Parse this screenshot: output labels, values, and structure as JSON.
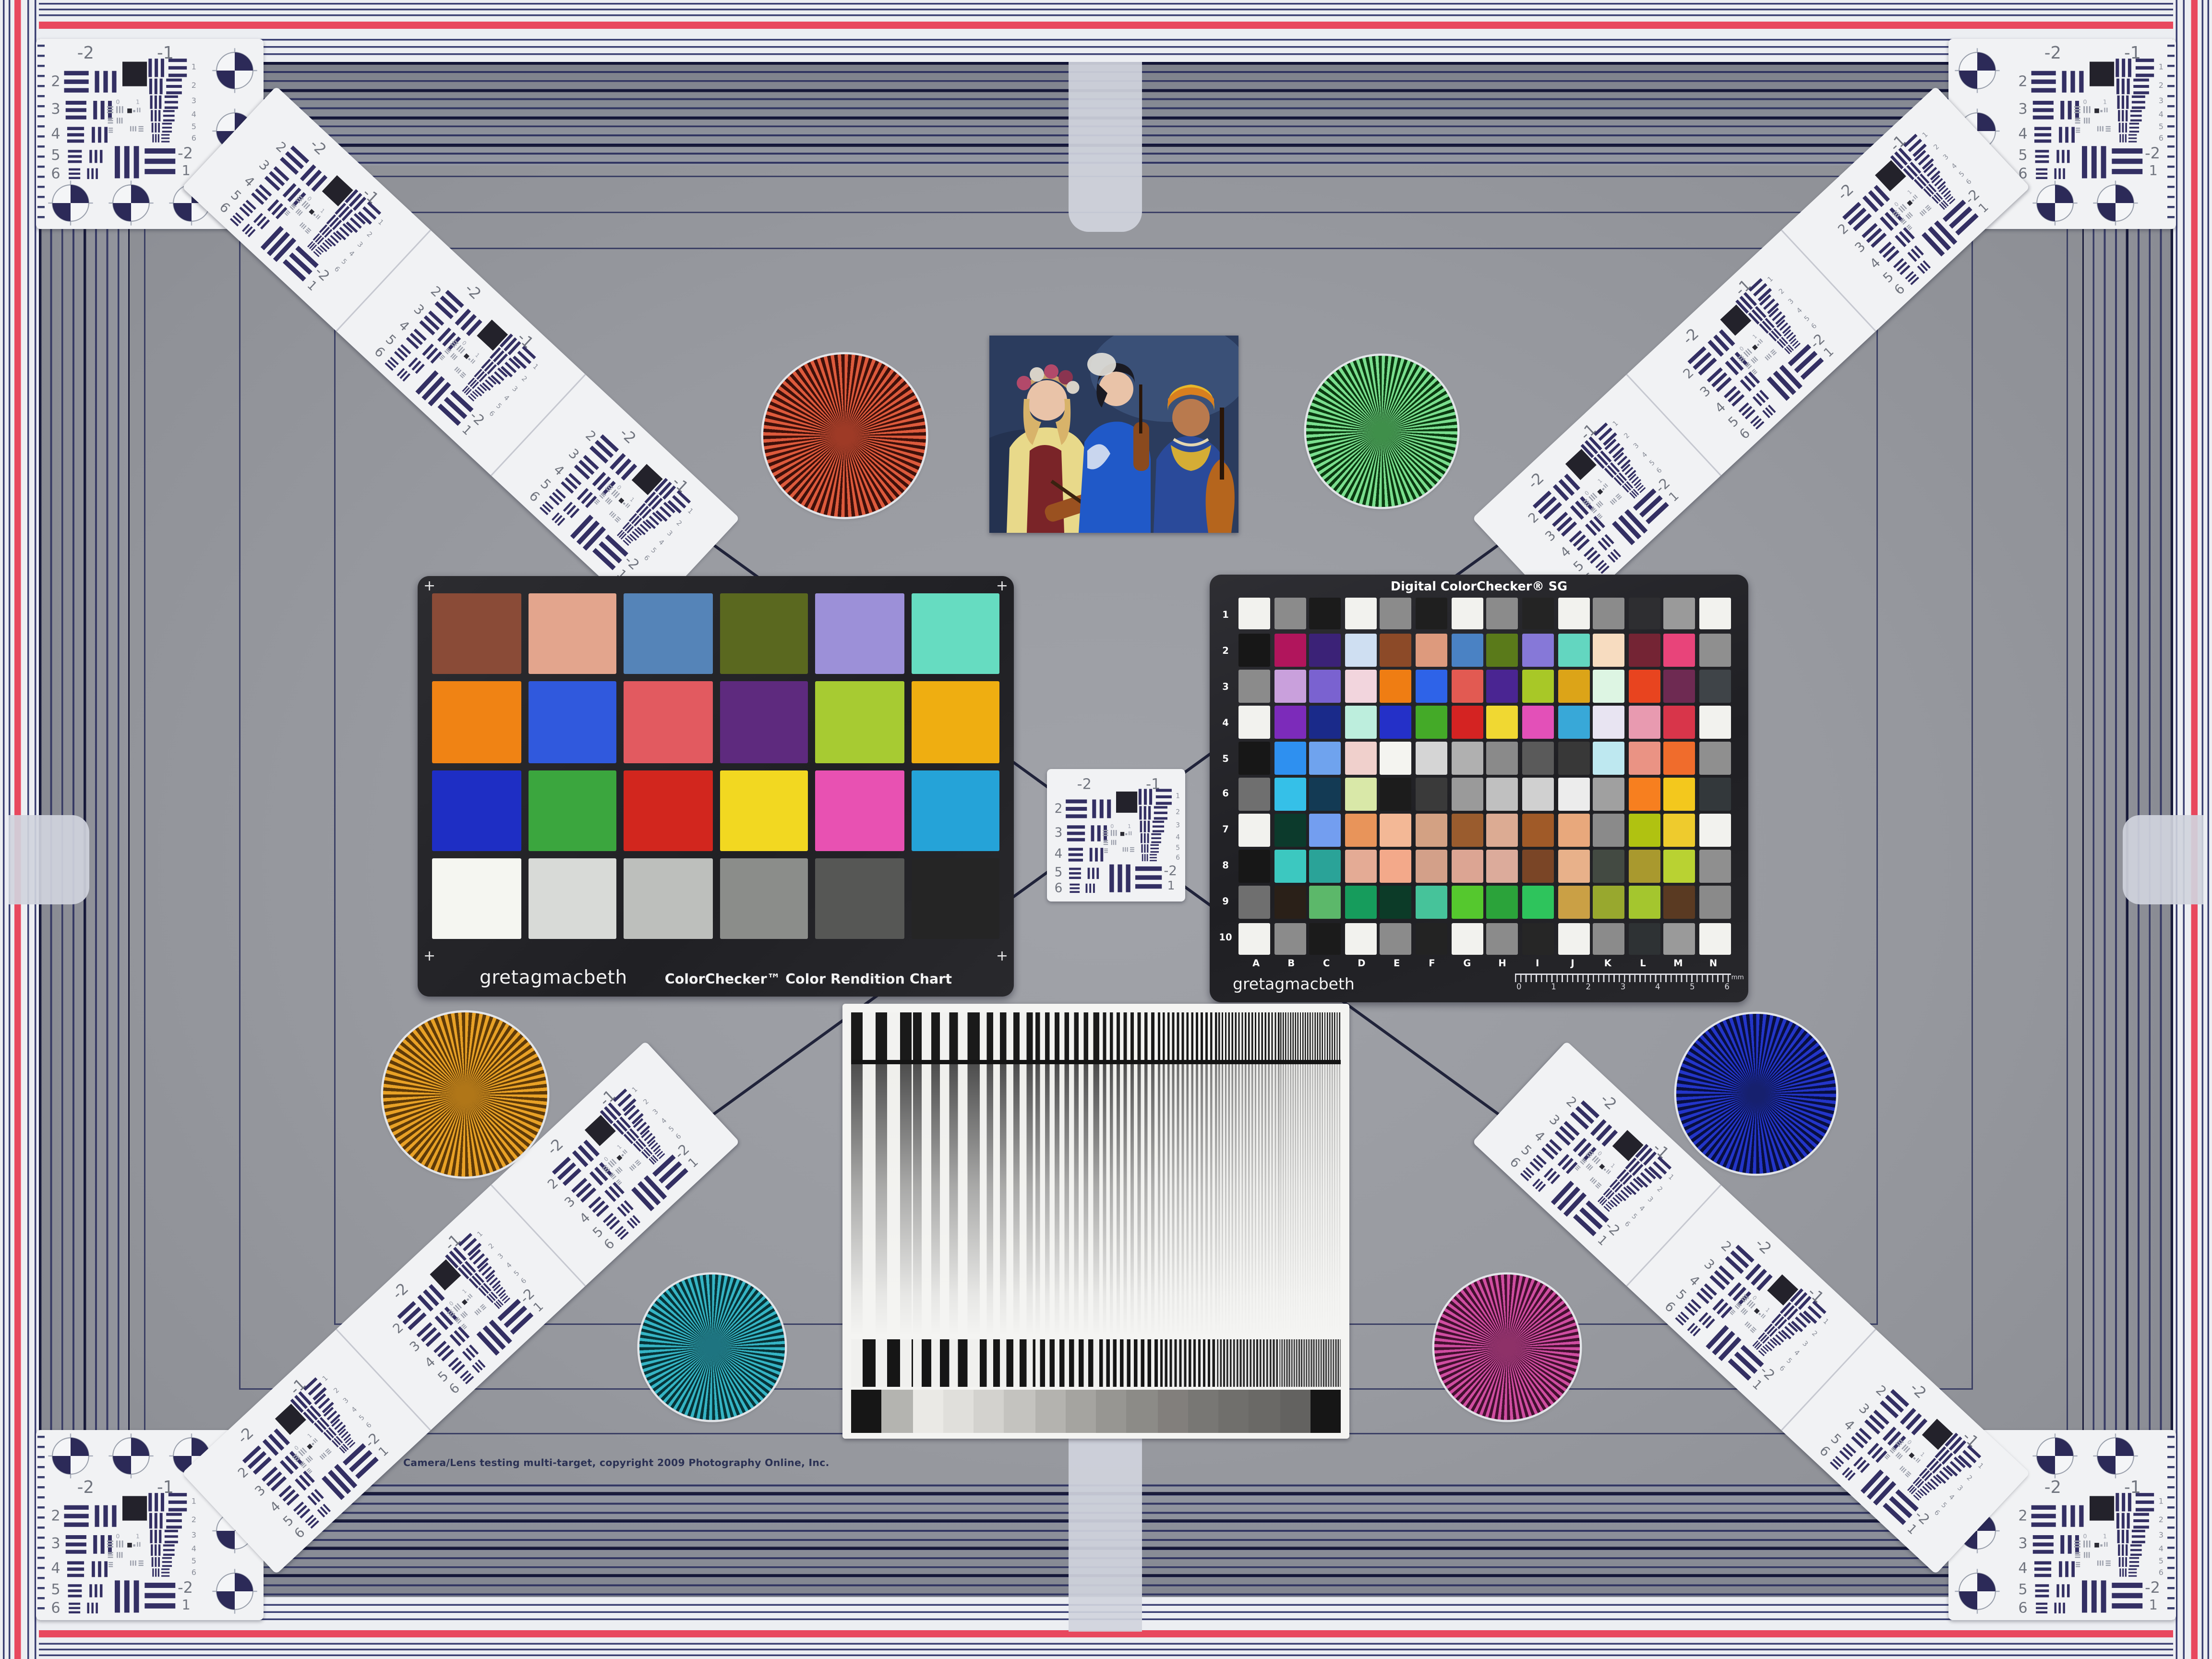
{
  "copyright": "Camera/Lens testing multi-target, copyright 2009 Photography Online, Inc.",
  "palette": {
    "red_stripe": "#e8485e",
    "card_white": "#f1f2f4",
    "usaf_ink": "#332f63",
    "usaf_num": "#71757f",
    "pin_navy": "#343a6e"
  },
  "colorchecker": {
    "brand": "gretagmacbeth",
    "title": "ColorChecker™ Color Rendition Chart",
    "corner_mark": "+",
    "patches": [
      "#8a4b37",
      "#e3a58d",
      "#5584b8",
      "#5a681f",
      "#9c90d8",
      "#66dcc1",
      "#f08314",
      "#3059dd",
      "#e25a60",
      "#5e2a7e",
      "#a7cb32",
      "#efae11",
      "#1e2ec4",
      "#3ba63e",
      "#d2261e",
      "#f2d821",
      "#e851b2",
      "#25a3d8",
      "#f5f6f1",
      "#d8dad7",
      "#bdbfbc",
      "#8b8d8a",
      "#565755",
      "#252525"
    ]
  },
  "sg": {
    "title": "Digital ColorChecker® SG",
    "brand": "gretagmacbeth",
    "row_labels": [
      "1",
      "2",
      "3",
      "4",
      "5",
      "6",
      "7",
      "8",
      "9",
      "10"
    ],
    "col_labels": [
      "A",
      "B",
      "C",
      "D",
      "E",
      "F",
      "G",
      "H",
      "I",
      "J",
      "K",
      "L",
      "M",
      "N"
    ],
    "ruler_numbers": [
      "0",
      "1",
      "2",
      "3",
      "4",
      "5",
      "6"
    ],
    "ruler_unit": "mm",
    "patches": [
      "#f2f2ee",
      "#8b8b8b",
      "#1b1b1b",
      "#f2f2ee",
      "#8b8b8b",
      "#1f1f1f",
      "#f2f2ee",
      "#8b8b8b",
      "#242424",
      "#f2f2ee",
      "#8b8b8b",
      "#2e2e31",
      "#9a9a9a",
      "#f2f2ee",
      "#171717",
      "#b1155c",
      "#3b2277",
      "#cfdff2",
      "#8c4a28",
      "#dd9a7d",
      "#4a82c4",
      "#5a7a1a",
      "#8678d8",
      "#63d6c0",
      "#f7dcc0",
      "#742434",
      "#e8447a",
      "#8f8f8f",
      "#8b8b8b",
      "#c9a0dc",
      "#7a62d0",
      "#f2d5dd",
      "#ef7d13",
      "#2e63e8",
      "#e25a52",
      "#4a2592",
      "#a8c827",
      "#dca418",
      "#ddf5e3",
      "#e8441f",
      "#6e2a52",
      "#3f4448",
      "#f2f2ee",
      "#7c2bba",
      "#1a2a8a",
      "#bdeedd",
      "#2430c8",
      "#44aa28",
      "#d42322",
      "#f0d832",
      "#e350b8",
      "#38a8d8",
      "#e8e4f2",
      "#e89ab0",
      "#d8354a",
      "#f2f2ee",
      "#171717",
      "#2e90f0",
      "#6fa3ee",
      "#f0d0cc",
      "#f4f4f0",
      "#d5d5d5",
      "#b0b0b0",
      "#8a8a8a",
      "#5a5a5a",
      "#383838",
      "#bee8f0",
      "#ea9384",
      "#f06c2c",
      "#8f8f8f",
      "#6f6f6f",
      "#35c0e8",
      "#133a54",
      "#d9e8a8",
      "#1c1c1c",
      "#3a3a3a",
      "#9a9a9a",
      "#c0c0c0",
      "#d0d0d0",
      "#ececec",
      "#a0a0a0",
      "#f77f1f",
      "#f3c81d",
      "#33383b",
      "#f2f2ee",
      "#0c3a2c",
      "#739ef0",
      "#e8945a",
      "#f3b896",
      "#d3a183",
      "#9a5c2e",
      "#dcab93",
      "#a05a28",
      "#e8a87c",
      "#8a8a8a",
      "#b0c211",
      "#eecb2d",
      "#f2f2ee",
      "#171717",
      "#3cc8c0",
      "#2aa398",
      "#e4ab95",
      "#f3a98a",
      "#d3a089",
      "#dca593",
      "#dcab9b",
      "#7a4526",
      "#e8b18a",
      "#434a42",
      "#a9992e",
      "#b9d232",
      "#8f8f8f",
      "#6f6f6f",
      "#2a2018",
      "#5cb86a",
      "#169c5c",
      "#0c3b28",
      "#46c39a",
      "#55c82e",
      "#2ba33a",
      "#2ec45c",
      "#caa045",
      "#98a82e",
      "#a4c62e",
      "#5a3a22",
      "#8a8a8a",
      "#f2f2ee",
      "#8b8b8b",
      "#1b1b1b",
      "#f2f2ee",
      "#8b8b8b",
      "#232323",
      "#f2f2ee",
      "#8b8b8b",
      "#262626",
      "#f2f2ee",
      "#8b8b8b",
      "#2e3234",
      "#9a9a9a",
      "#f2f2ee"
    ]
  },
  "usaf": {
    "group_top_left": "-2",
    "group_top_right": "-1",
    "left_numbers": [
      "2",
      "3",
      "4",
      "5",
      "6"
    ],
    "right_numbers": [
      "1",
      "2",
      "3",
      "4",
      "5",
      "6"
    ],
    "bottom_group": "-2",
    "bottom_element": "1",
    "inner_zero": "0",
    "inner_one": "1"
  },
  "stars": [
    {
      "name": "red",
      "light": "#dd5a3c",
      "dark": "#3f100a",
      "mid": "#9e3a26"
    },
    {
      "name": "green",
      "light": "#7ade8e",
      "dark": "#0a3a10",
      "mid": "#3f8f4a"
    },
    {
      "name": "orange",
      "light": "#e8a126",
      "dark": "#5e3a08",
      "mid": "#b07618"
    },
    {
      "name": "blue",
      "light": "#2335c8",
      "dark": "#080f40",
      "mid": "#16206e"
    },
    {
      "name": "teal",
      "light": "#35b4c4",
      "dark": "#073438",
      "mid": "#1e7480"
    },
    {
      "name": "magenta",
      "light": "#cf4da0",
      "dark": "#43102f",
      "mid": "#8e3168"
    }
  ],
  "sweep_steps": [
    "#161616",
    "#b4b4b0",
    "#eae9e5",
    "#e0dfdb",
    "#d3d2ce",
    "#c4c3bf",
    "#b4b3af",
    "#a5a4a0",
    "#979692",
    "#8c8b87",
    "#827f7c",
    "#787774",
    "#706f6c",
    "#6a6966",
    "#636260",
    "#161616"
  ],
  "photo_palette": {
    "backdrop": "#2b3c5e",
    "backdrop_light": "#4a6490",
    "skin_light": "#e9c3a8",
    "skin_dark": "#b97a4e",
    "blonde_hair": "#d8b36a",
    "black_hair": "#1a1a22",
    "yellow_dress": "#e8d98a",
    "red_vest": "#7a2428",
    "blue_kimono": "#2059c8",
    "headwrap_yellow": "#e8b82a",
    "instrument_brown": "#9a5120"
  }
}
